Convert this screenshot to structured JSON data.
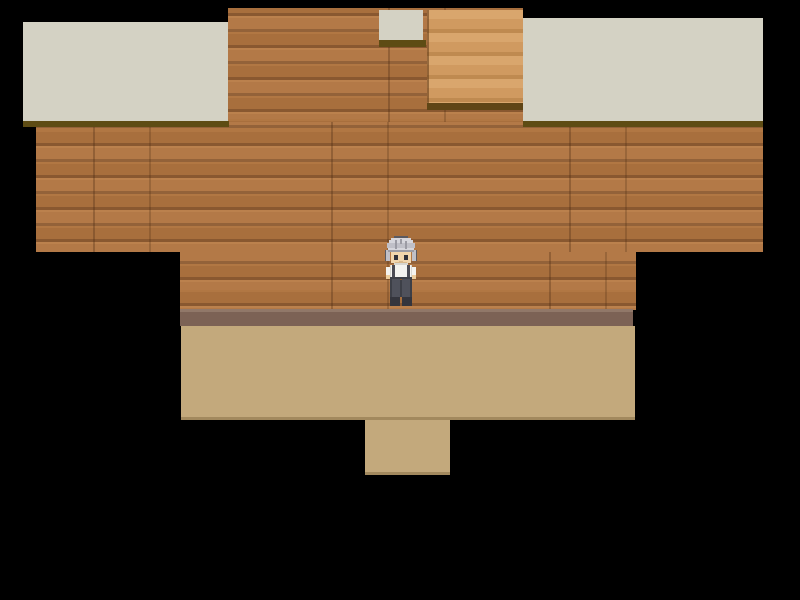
{
  "meta": {
    "type": "game-screenshot",
    "view": "top-down 2D RPG interior with surrounding black void",
    "canvas": {
      "width": 800,
      "height": 600
    }
  },
  "scene": {
    "background_color": "#000000",
    "palette": {
      "wood_plank": "#ae723e",
      "wood_plank_highlight": "#b97c46",
      "wood_seam": "#8f5c32",
      "roof_gray": "#d4d2c4",
      "roof_shadow_olive": "#5e4c14",
      "stairs_base": "#d09a60",
      "stairs_light_band": "#d9a66d",
      "stairs_dark_band": "#bf8a50",
      "stairs_shadow": "#5f4516",
      "baseboard_mauve": "#7c6255",
      "baseboard_highlight": "#917869",
      "floor_tan": "#c3a97c",
      "void": "#000000"
    },
    "regions": [
      {
        "name": "wood-wall-upper",
        "type": "wood",
        "x": 228,
        "y": 8,
        "w": 295,
        "h": 119
      },
      {
        "name": "wood-wall-middle",
        "type": "wood",
        "x": 36,
        "y": 122,
        "w": 727,
        "h": 130
      },
      {
        "name": "wood-wall-lower",
        "type": "wood",
        "x": 180,
        "y": 252,
        "w": 456,
        "h": 58
      },
      {
        "name": "awning-left",
        "type": "roof",
        "x": 23,
        "y": 22,
        "w": 205,
        "h": 99
      },
      {
        "name": "awning-left-shadow",
        "type": "roof-shadow",
        "x": 23,
        "y": 121,
        "w": 206,
        "h": 6
      },
      {
        "name": "awning-small-top",
        "type": "roof",
        "x": 379,
        "y": 10,
        "w": 44,
        "h": 30
      },
      {
        "name": "awning-small-top-shadow",
        "type": "roof-shadow",
        "x": 379,
        "y": 40,
        "w": 47,
        "h": 7
      },
      {
        "name": "staircase-top",
        "type": "stairs",
        "x": 427,
        "y": 10,
        "w": 96,
        "h": 93
      },
      {
        "name": "staircase-shadow",
        "type": "stairs-shadow",
        "x": 427,
        "y": 103,
        "w": 96,
        "h": 7
      },
      {
        "name": "awning-right",
        "type": "roof",
        "x": 523,
        "y": 18,
        "w": 240,
        "h": 103
      },
      {
        "name": "awning-right-shadow",
        "type": "roof-shadow",
        "x": 523,
        "y": 121,
        "w": 240,
        "h": 6
      },
      {
        "name": "baseboard",
        "type": "baseboard",
        "x": 180,
        "y": 309,
        "w": 453,
        "h": 17
      },
      {
        "name": "floor-main",
        "type": "floor",
        "x": 181,
        "y": 326,
        "w": 454,
        "h": 94
      },
      {
        "name": "floor-entry",
        "type": "floor",
        "x": 365,
        "y": 420,
        "w": 85,
        "h": 55
      }
    ],
    "character": {
      "name": "player-character",
      "description": "gray-haired villager sprite facing down, white shirt with dark suspenders, dark trousers",
      "x": 384,
      "y": 236,
      "w": 34,
      "h": 71,
      "palette": {
        "outline": "#5a5a62",
        "hair_light": "#d6d6dc",
        "hair_mid": "#c0c0c8",
        "hair_shade": "#9b9ba4",
        "skin": "#f2d6ac",
        "skin_shade": "#d9b98c",
        "eyes": "#32323a",
        "shirt": "#f4f3ef",
        "shirt_shade": "#d8d7d1",
        "suspenders": "#4b4b54",
        "hands": "#eccd9d",
        "pants": "#4f515b",
        "pants_dark": "#3d3f47",
        "shoes": "#34353d"
      }
    }
  }
}
